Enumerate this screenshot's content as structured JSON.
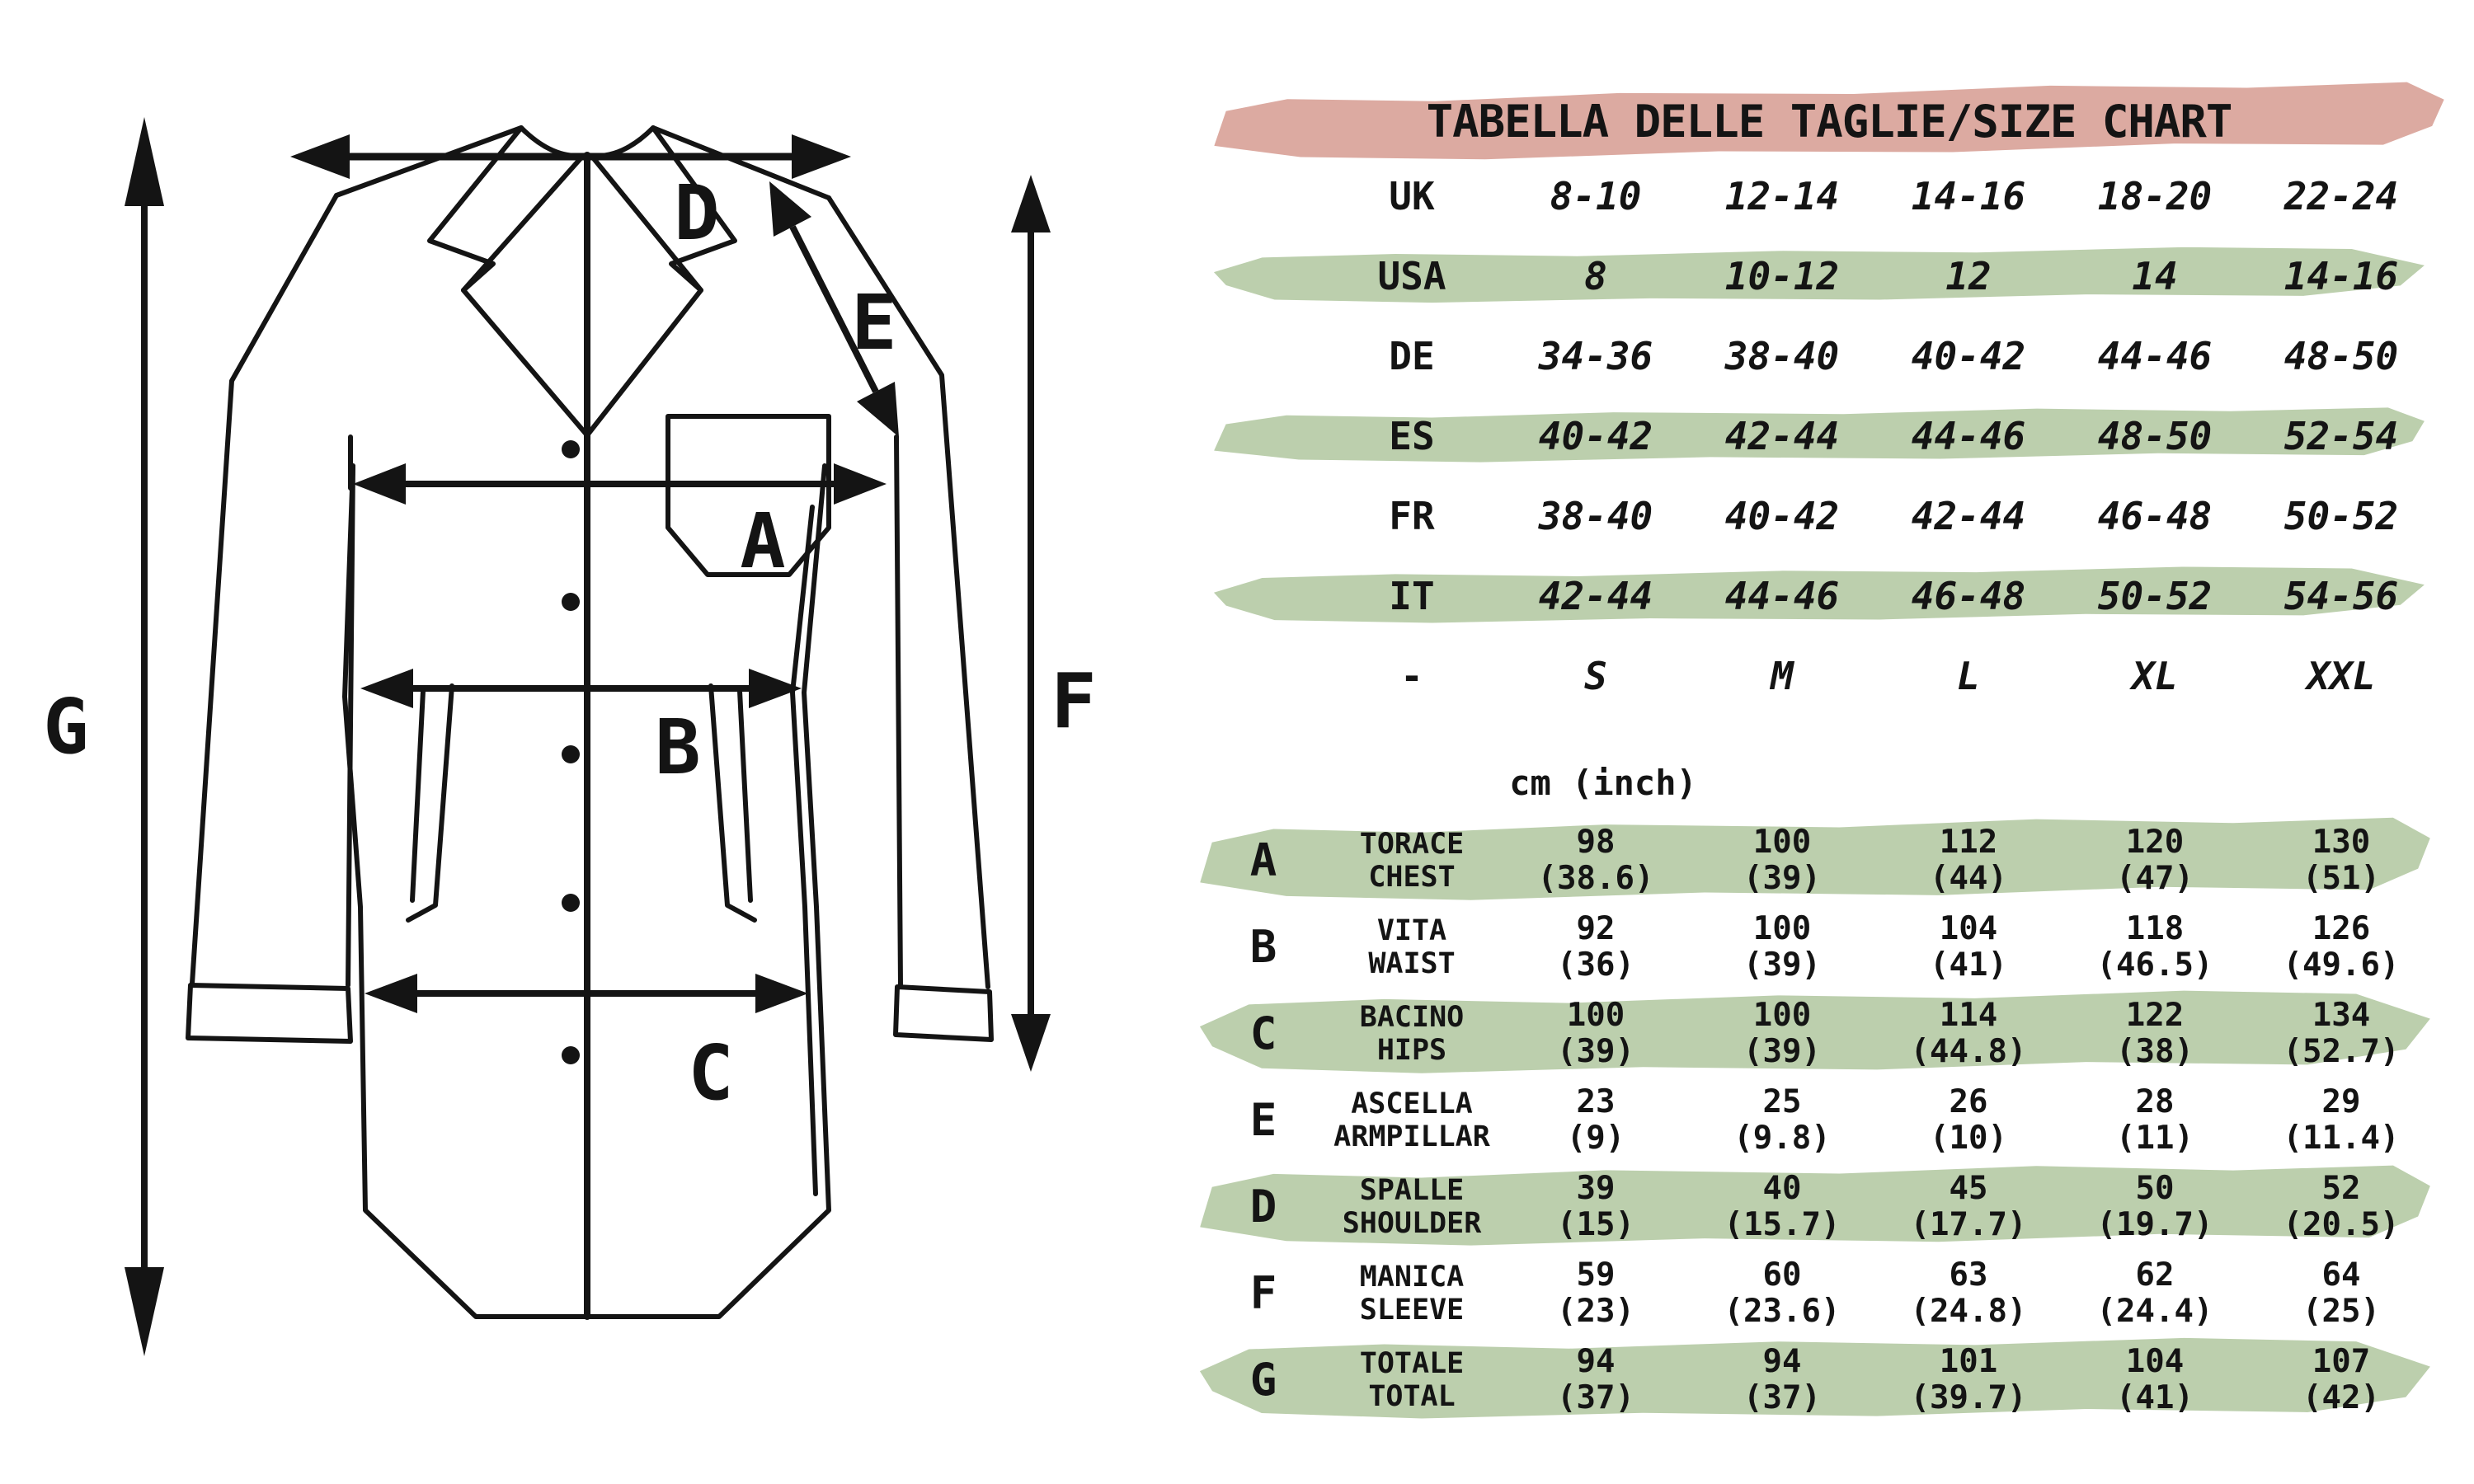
{
  "title": "TABELLA DELLE TAGLIE/SIZE CHART",
  "unit_label": "cm (inch)",
  "colors": {
    "highlight_green": "#bccfad",
    "title_pink": "#dcaaa1",
    "ink": "#141414"
  },
  "sizes": [
    {
      "region": "UK",
      "highlight": false,
      "values": [
        "8-10",
        "12-14",
        "14-16",
        "18-20",
        "22-24"
      ]
    },
    {
      "region": "USA",
      "highlight": true,
      "values": [
        "8",
        "10-12",
        "12",
        "14",
        "14-16"
      ]
    },
    {
      "region": "DE",
      "highlight": false,
      "values": [
        "34-36",
        "38-40",
        "40-42",
        "44-46",
        "48-50"
      ]
    },
    {
      "region": "ES",
      "highlight": true,
      "values": [
        "40-42",
        "42-44",
        "44-46",
        "48-50",
        "52-54"
      ]
    },
    {
      "region": "FR",
      "highlight": false,
      "values": [
        "38-40",
        "40-42",
        "42-44",
        "46-48",
        "50-52"
      ]
    },
    {
      "region": "IT",
      "highlight": true,
      "values": [
        "42-44",
        "44-46",
        "46-48",
        "50-52",
        "54-56"
      ]
    },
    {
      "region": "-",
      "highlight": false,
      "values": [
        "S",
        "M",
        "L",
        "XL",
        "XXL"
      ]
    }
  ],
  "meas": [
    {
      "letter": "A",
      "it": "TORACE",
      "en": "CHEST",
      "highlight": true,
      "cm": [
        "98",
        "100",
        "112",
        "120",
        "130"
      ],
      "inch": [
        "(38.6)",
        "(39)",
        "(44)",
        "(47)",
        "(51)"
      ]
    },
    {
      "letter": "B",
      "it": "VITA",
      "en": "WAIST",
      "highlight": false,
      "cm": [
        "92",
        "100",
        "104",
        "118",
        "126"
      ],
      "inch": [
        "(36)",
        "(39)",
        "(41)",
        "(46.5)",
        "(49.6)"
      ]
    },
    {
      "letter": "C",
      "it": "BACINO",
      "en": "HIPS",
      "highlight": true,
      "cm": [
        "100",
        "100",
        "114",
        "122",
        "134"
      ],
      "inch": [
        "(39)",
        "(39)",
        "(44.8)",
        "(38)",
        "(52.7)"
      ]
    },
    {
      "letter": "E",
      "it": "ASCELLA",
      "en": "ARMPILLAR",
      "highlight": false,
      "cm": [
        "23",
        "25",
        "26",
        "28",
        "29"
      ],
      "inch": [
        "(9)",
        "(9.8)",
        "(10)",
        "(11)",
        "(11.4)"
      ]
    },
    {
      "letter": "D",
      "it": "SPALLE",
      "en": "SHOULDER",
      "highlight": true,
      "cm": [
        "39",
        "40",
        "45",
        "50",
        "52"
      ],
      "inch": [
        "(15)",
        "(15.7)",
        "(17.7)",
        "(19.7)",
        "(20.5)"
      ]
    },
    {
      "letter": "F",
      "it": "MANICA",
      "en": "SLEEVE",
      "highlight": false,
      "cm": [
        "59",
        "60",
        "63",
        "62",
        "64"
      ],
      "inch": [
        "(23)",
        "(23.6)",
        "(24.8)",
        "(24.4)",
        "(25)"
      ]
    },
    {
      "letter": "G",
      "it": "TOTALE",
      "en": "TOTAL",
      "highlight": true,
      "cm": [
        "94",
        "94",
        "101",
        "104",
        "107"
      ],
      "inch": [
        "(37)",
        "(37)",
        "(39.7)",
        "(41)",
        "(42)"
      ]
    }
  ],
  "diagram": {
    "letters": [
      "A",
      "B",
      "C",
      "D",
      "E",
      "F",
      "G"
    ]
  }
}
